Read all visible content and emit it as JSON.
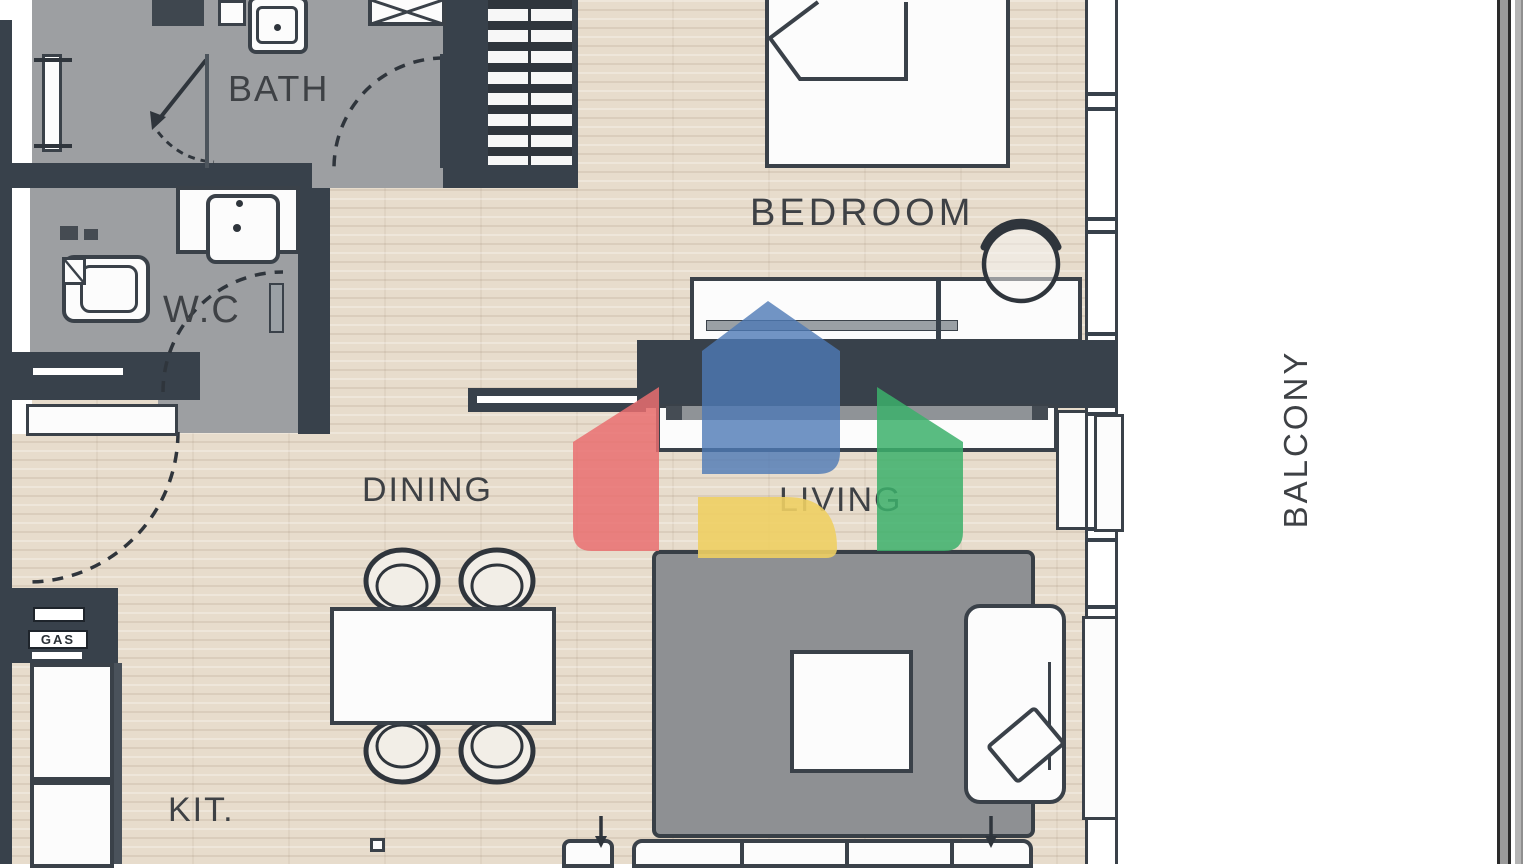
{
  "plan": {
    "title_hint": "apartment floor plan",
    "rooms": {
      "bath": {
        "label": "BATH"
      },
      "wc": {
        "label": "W.C"
      },
      "bedroom": {
        "label": "BEDROOM"
      },
      "dining": {
        "label": "DINING"
      },
      "living": {
        "label": "LIVING"
      },
      "kitchen": {
        "label": "KIT."
      },
      "balcony": {
        "label": "BALCONY"
      }
    },
    "annotations": {
      "gas": "GAS"
    },
    "icons": {
      "watermark": "house-logo-watermark"
    },
    "colors": {
      "wall": "#38414b",
      "wood_floor": "#e7dccc",
      "tile_floor": "#9d9fa2",
      "rug": "#8e9093",
      "outline": "#3a4149",
      "logo_blue": "#4d79b5",
      "logo_red": "#e96f70",
      "logo_green": "#3cb06b",
      "logo_yellow": "#eecf63"
    }
  }
}
